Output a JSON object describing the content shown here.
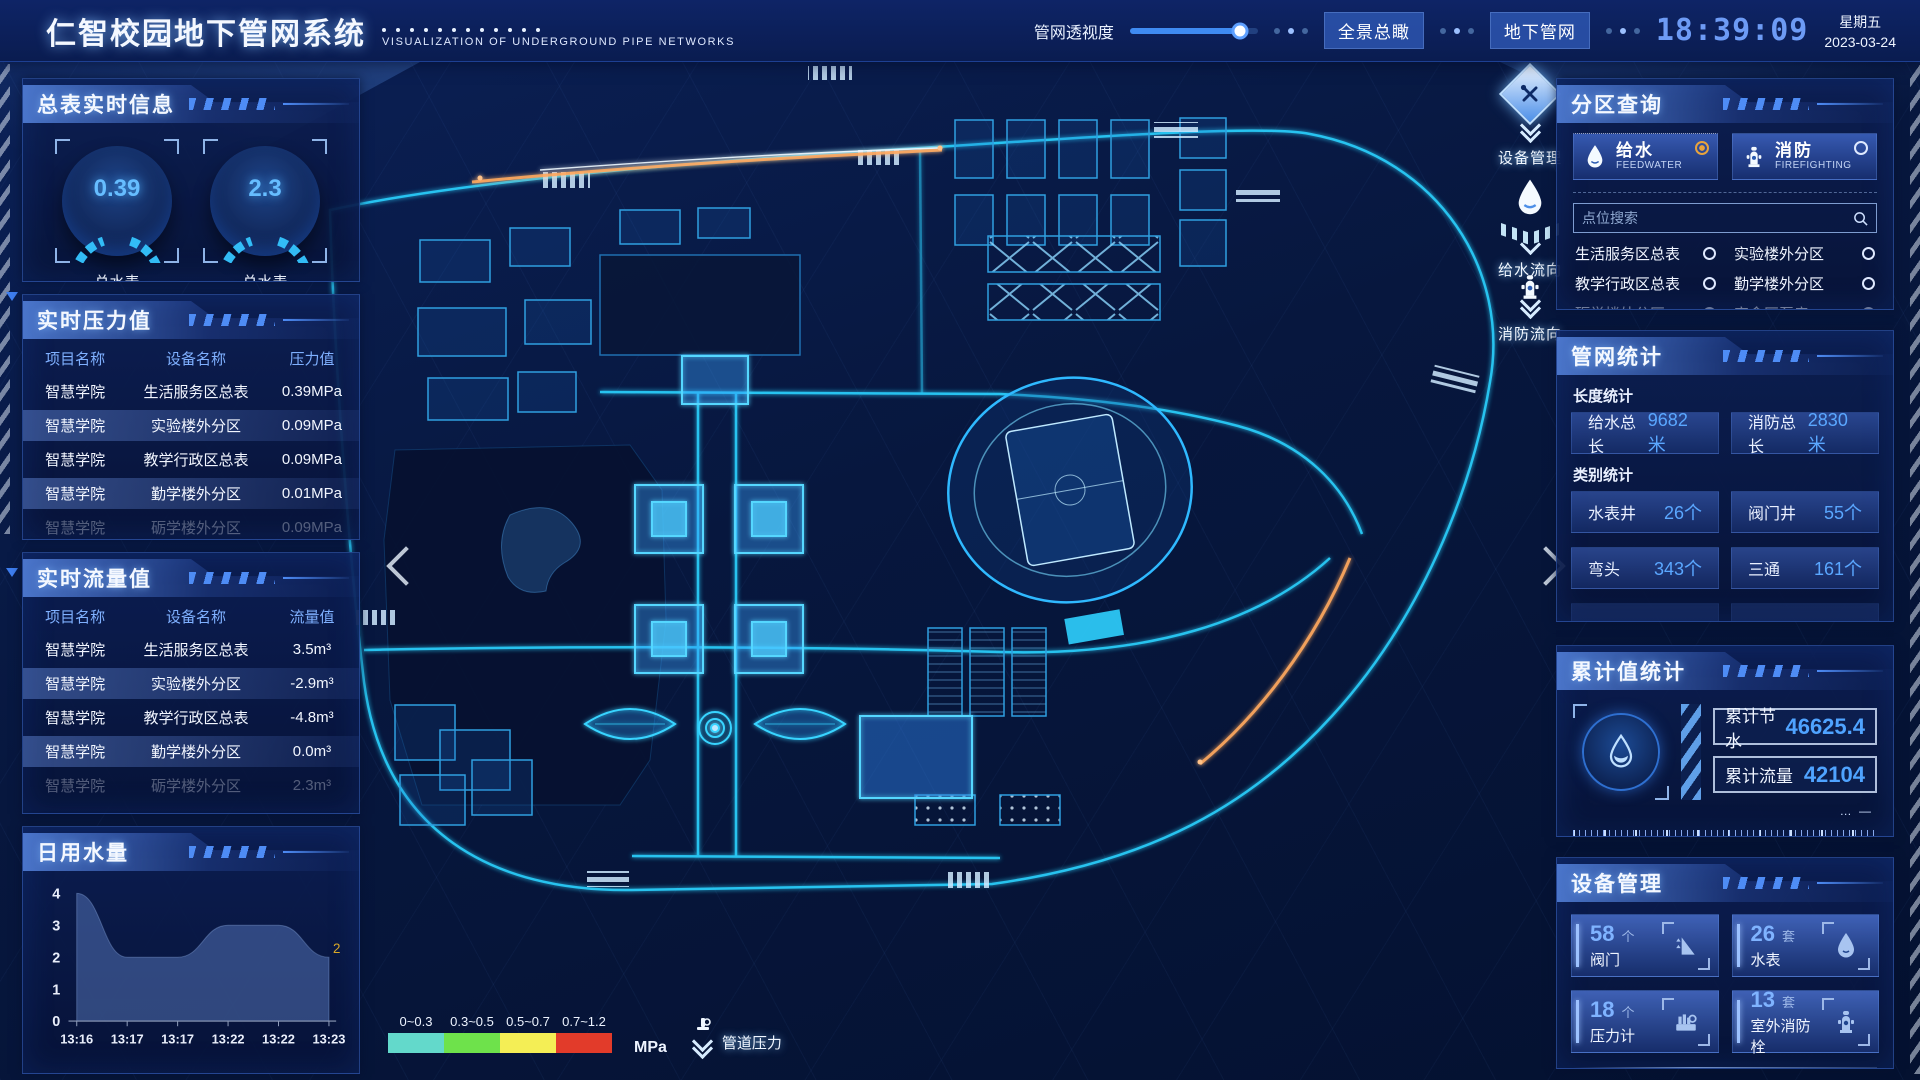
{
  "header": {
    "title": "仁智校园地下管网系统",
    "subtitle": "VISUALIZATION OF UNDERGROUND PIPE NETWORKS",
    "transparency_label": "管网透视度",
    "btn_overview": "全景总瞰",
    "btn_underground": "地下管网",
    "clock": "18:39:09",
    "weekday": "星期五",
    "date": "2023-03-24"
  },
  "left": {
    "master_panel": {
      "title": "总表实时信息",
      "gauges": [
        {
          "value": "0.39",
          "label1": "总水表",
          "label2": "当前压力值"
        },
        {
          "value": "2.3",
          "label1": "总水表",
          "label2": "瞬时流量"
        }
      ]
    },
    "pressure_panel": {
      "title": "实时压力值",
      "headers": [
        "项目名称",
        "设备名称",
        "压力值"
      ],
      "rows": [
        {
          "project": "智慧学院",
          "device": "生活服务区总表",
          "value": "0.39MPa"
        },
        {
          "project": "智慧学院",
          "device": "实验楼外分区",
          "value": "0.09MPa"
        },
        {
          "project": "智慧学院",
          "device": "教学行政区总表",
          "value": "0.09MPa"
        },
        {
          "project": "智慧学院",
          "device": "勤学楼外分区",
          "value": "0.01MPa"
        },
        {
          "project": "智慧学院",
          "device": "砺学楼外分区",
          "value": "0.09MPa"
        }
      ]
    },
    "flow_panel": {
      "title": "实时流量值",
      "headers": [
        "项目名称",
        "设备名称",
        "流量值"
      ],
      "rows": [
        {
          "project": "智慧学院",
          "device": "生活服务区总表",
          "value": "3.5m³"
        },
        {
          "project": "智慧学院",
          "device": "实验楼外分区",
          "value": "-2.9m³"
        },
        {
          "project": "智慧学院",
          "device": "教学行政区总表",
          "value": "-4.8m³"
        },
        {
          "project": "智慧学院",
          "device": "勤学楼外分区",
          "value": "0.0m³"
        },
        {
          "project": "智慧学院",
          "device": "砺学楼外分区",
          "value": "2.3m³"
        }
      ]
    },
    "daily_panel": {
      "title": "日用水量",
      "chart_data": {
        "type": "area",
        "x": [
          "13:16",
          "13:17",
          "13:17",
          "13:22",
          "13:22",
          "13:23"
        ],
        "values": [
          4,
          2,
          2,
          3,
          3,
          2
        ],
        "ylim": [
          0,
          4
        ],
        "yticks": [
          0,
          1,
          2,
          3,
          4
        ],
        "end_label": "2",
        "end_label_color": "#d9a827",
        "fill_color": "rgba(88,122,190,0.5)"
      }
    }
  },
  "map": {
    "tools": [
      {
        "label": "设备管理",
        "icon": "tools-icon"
      },
      {
        "label": "给水流向",
        "icon": "waterdrop-icon"
      },
      {
        "label": "消防流向",
        "icon": "hydrant-icon"
      }
    ],
    "legend": {
      "ranges": [
        {
          "label": "0~0.3",
          "color": "#63d9cb"
        },
        {
          "label": "0.3~0.5",
          "color": "#6ee24b"
        },
        {
          "label": "0.5~0.7",
          "color": "#f4ee55"
        },
        {
          "label": "0.7~1.2",
          "color": "#e23b2a"
        }
      ],
      "unit": "MPa",
      "pressure_label": "管道压力"
    }
  },
  "right": {
    "zone_panel": {
      "title": "分区查询",
      "tabs": [
        {
          "label": "给水",
          "sub": "FEEDWATER",
          "selected": true
        },
        {
          "label": "消防",
          "sub": "FIREFIGHTING",
          "selected": false
        }
      ],
      "search_placeholder": "点位搜索",
      "zones": [
        "生活服务区总表",
        "实验楼外分区",
        "教学行政区总表",
        "勤学楼外分区",
        "砺学楼外分区",
        "宿舍区泵房"
      ]
    },
    "network_panel": {
      "title": "管网统计",
      "length_label": "长度统计",
      "length_stats": [
        {
          "label": "给水总长",
          "value": "9682米"
        },
        {
          "label": "消防总长",
          "value": "2830米"
        }
      ],
      "category_label": "类别统计",
      "category_stats": [
        {
          "label": "水表井",
          "value": "26个"
        },
        {
          "label": "阀门井",
          "value": "55个"
        },
        {
          "label": "弯头",
          "value": "343个"
        },
        {
          "label": "三通",
          "value": "161个"
        }
      ]
    },
    "cumulative_panel": {
      "title": "累计值统计",
      "stats": [
        {
          "label": "累计节水",
          "value": "46625.4"
        },
        {
          "label": "累计流量",
          "value": "42104"
        }
      ]
    },
    "device_panel": {
      "title": "设备管理",
      "cards": [
        {
          "count": "58",
          "unit": "个",
          "label": "阀门",
          "icon": "valve-icon"
        },
        {
          "count": "26",
          "unit": "套",
          "label": "水表",
          "icon": "water-meter-icon"
        },
        {
          "count": "18",
          "unit": "个",
          "label": "压力计",
          "icon": "pressure-gauge-icon"
        },
        {
          "count": "13",
          "unit": "套",
          "label": "室外消防栓",
          "icon": "hydrant-icon"
        }
      ]
    }
  }
}
